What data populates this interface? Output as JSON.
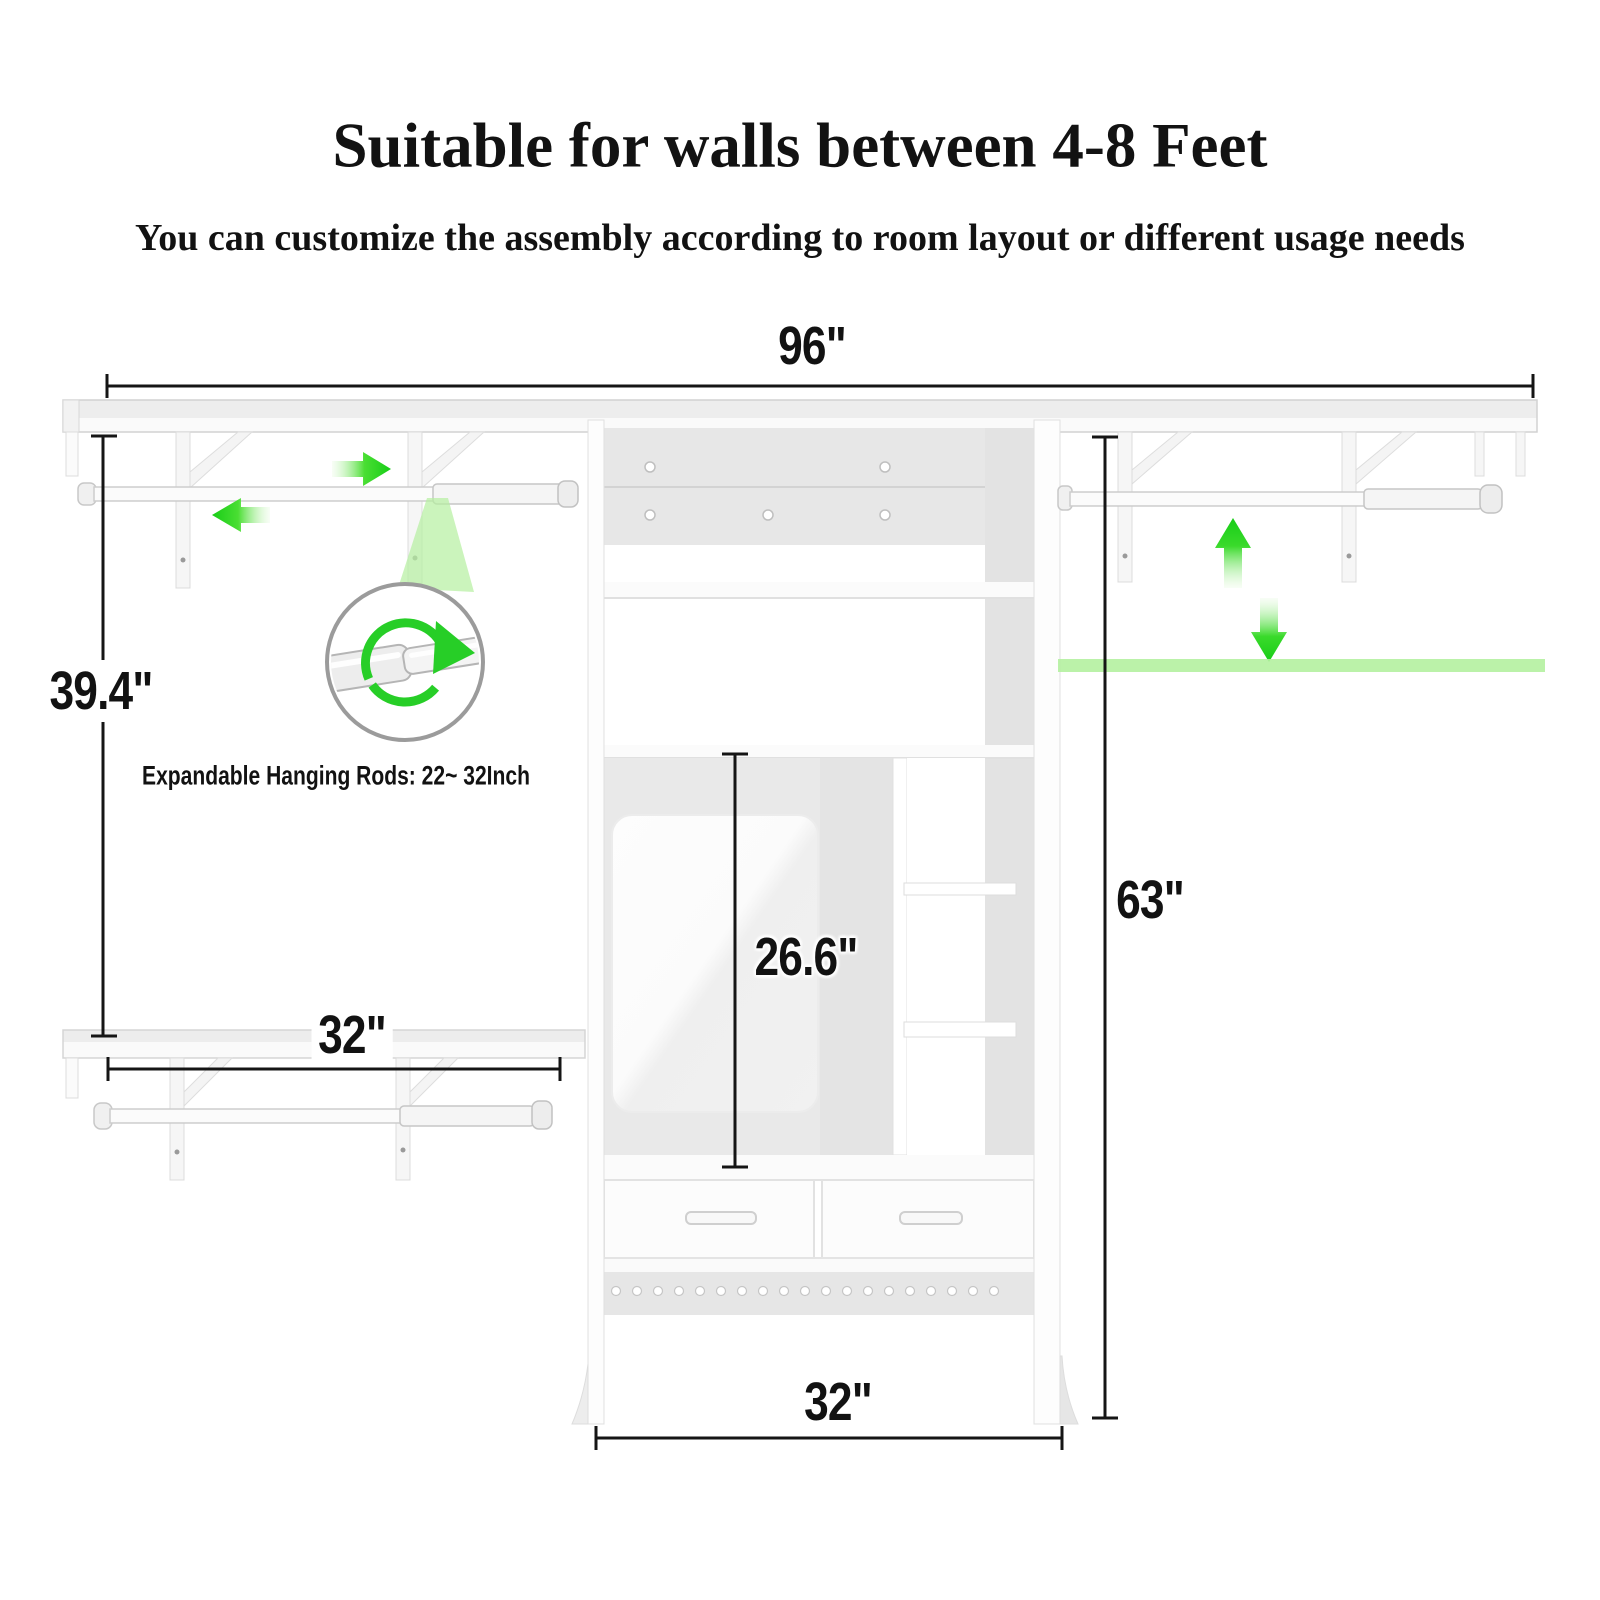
{
  "header": {
    "title": "Suitable for walls between 4-8 Feet",
    "subtitle": "You can customize the assembly according to room layout or different usage needs"
  },
  "dimensions": {
    "total_width": "96\"",
    "left_section_height": "39.4\"",
    "left_rod_width": "32\"",
    "mirror_height": "26.6\"",
    "tower_height": "63\"",
    "tower_width": "32\""
  },
  "callout": {
    "text": "Expandable Hanging Rods: 22~ 32Inch"
  },
  "colors": {
    "accent_green": "#1ecf1e",
    "highlight_green": "#b4f1a0",
    "dimension_line": "#151515",
    "panel_gray": "#e7e7e7"
  },
  "icons": {
    "expand_arrow_left": "◀",
    "expand_arrow_right": "▶",
    "move_arrow_up": "▲",
    "move_arrow_down": "▼",
    "rotate_arrow": "↻"
  }
}
